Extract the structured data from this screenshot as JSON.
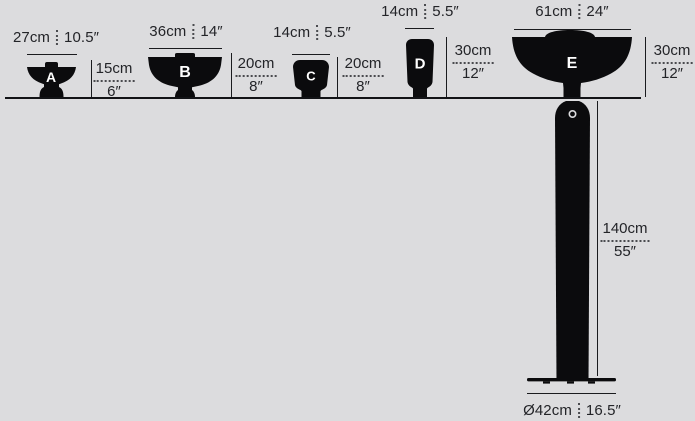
{
  "colors": {
    "background": "#dcdcde",
    "ink": "#1a1b1e",
    "lamp_fill": "#0b0b0d",
    "letter_color": "#ffffff"
  },
  "products": [
    {
      "letter": "A",
      "width_cm": "27cm",
      "width_in": "10.5″",
      "height_cm": "15cm",
      "height_in": "6″"
    },
    {
      "letter": "B",
      "width_cm": "36cm",
      "width_in": "14″",
      "height_cm": "20cm",
      "height_in": "8″"
    },
    {
      "letter": "C",
      "width_cm": "14cm",
      "width_in": "5.5″",
      "height_cm": "20cm",
      "height_in": "8″"
    },
    {
      "letter": "D",
      "width_cm": "14cm",
      "width_in": "5.5″",
      "height_cm": "30cm",
      "height_in": "12″"
    },
    {
      "letter": "E",
      "width_cm": "61cm",
      "width_in": "24″",
      "height_cm": "30cm",
      "height_in": "12″",
      "pole_height_cm": "140cm",
      "pole_height_in": "55″",
      "base_diameter_cm": "Ø42cm",
      "base_diameter_in": "16.5″"
    }
  ]
}
